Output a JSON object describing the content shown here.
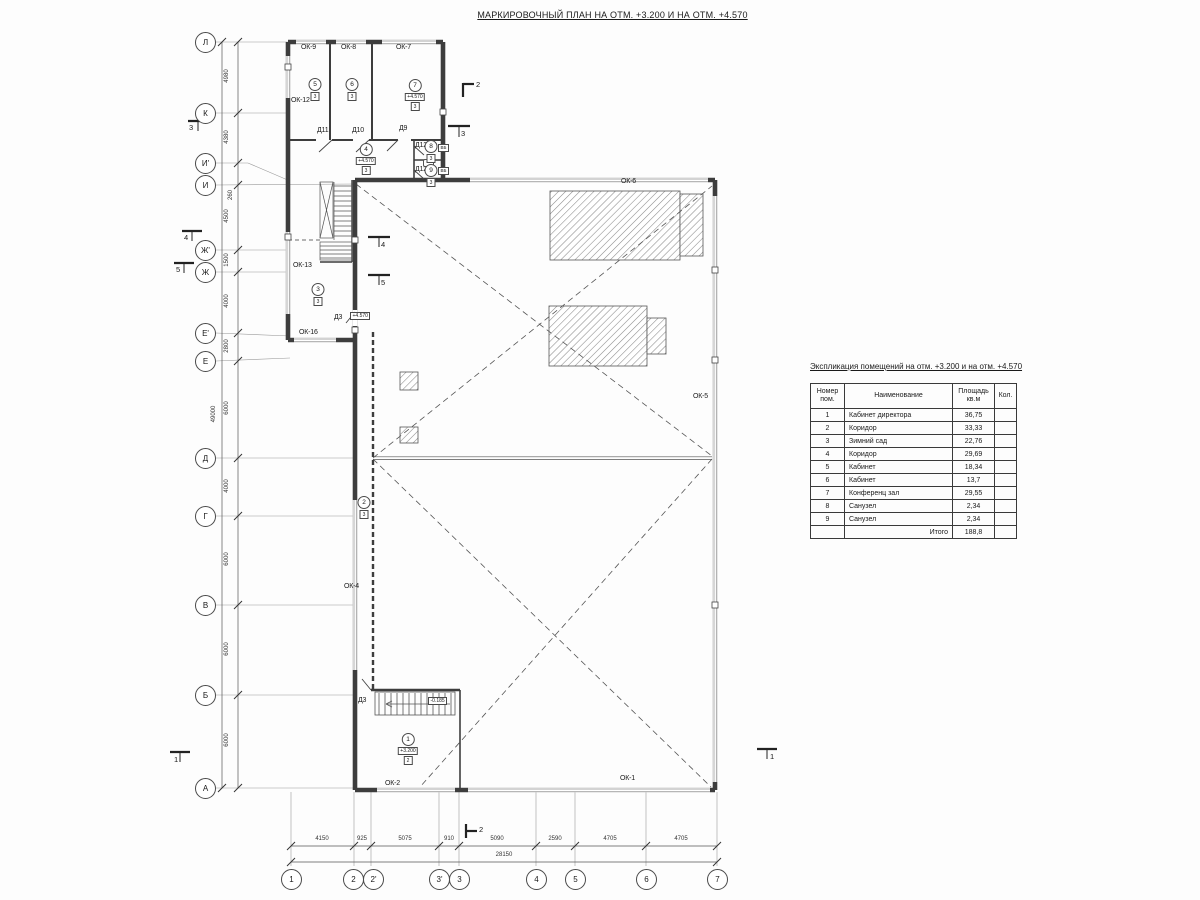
{
  "title": "МАРКИРОВОЧНЫЙ ПЛАН НА ОТМ. +3.200 И НА ОТМ. +4.570",
  "grid": {
    "rows": [
      "Л",
      "К",
      "И'",
      "И",
      "Ж'",
      "Ж",
      "Е'",
      "Е",
      "Д",
      "Г",
      "В",
      "Б",
      "А"
    ],
    "row_dims": [
      "4980",
      "4380",
      "260",
      "4500",
      "1500",
      "4000",
      "2800",
      "6000",
      "4000",
      "6000",
      "6000",
      "6000"
    ],
    "row_total": "49000",
    "cols": [
      "1",
      "2",
      "2'",
      "3'",
      "3",
      "4",
      "5",
      "6",
      "7"
    ],
    "col_dims": [
      "4150",
      "925",
      "5075",
      "910",
      "5090",
      "2590",
      "4705",
      "4705"
    ],
    "col_total": "28150"
  },
  "labels": {
    "ok9": "ОК-9",
    "ok8": "ОК-8",
    "ok7": "ОК-7",
    "ok12": "ОК-12",
    "ok13": "ОК-13",
    "ok16": "ОК-16",
    "ok6": "ОК-6",
    "ok5": "ОК-5",
    "ok4": "ОК-4",
    "ok2": "ОК-2",
    "ok1": "ОК-1",
    "d11": "Д11",
    "d10": "Д10",
    "d9": "Д9",
    "d12a": "Д12",
    "d12b": "Д12",
    "d3a": "Д3",
    "d3b": "Д3",
    "d3a_elev": "+4.570",
    "vb": "ВБ"
  },
  "rooms": [
    {
      "num": "1",
      "elev": "+3.200",
      "sub": "2"
    },
    {
      "num": "2",
      "sub": "3"
    },
    {
      "num": "3",
      "sub": "3"
    },
    {
      "num": "4",
      "elev": "+4.570",
      "sub": "3"
    },
    {
      "num": "5",
      "sub": "3"
    },
    {
      "num": "6",
      "sub": "3"
    },
    {
      "num": "7",
      "elev": "+4.570",
      "sub": "3"
    },
    {
      "num": "8",
      "sub": "3"
    },
    {
      "num": "9",
      "sub": "3"
    }
  ],
  "elev": {
    "stair": "-0.185"
  },
  "sections": {
    "s1": "1",
    "s2": "2",
    "s3": "3",
    "s4": "4",
    "s5": "5"
  },
  "table": {
    "title": "Экспликация помещений на отм. +3.200 и на отм. +4.570",
    "headers": {
      "num_l1": "Номер",
      "num_l2": "пом.",
      "name": "Наименование",
      "area_l1": "Площадь",
      "area_l2": "кв.м",
      "qty": "Кол."
    },
    "rows": [
      [
        "1",
        "Кабинет директора",
        "36,75"
      ],
      [
        "2",
        "Коридор",
        "33,33"
      ],
      [
        "3",
        "Зимний сад",
        "22,76"
      ],
      [
        "4",
        "Коридор",
        "29,69"
      ],
      [
        "5",
        "Кабинет",
        "18,34"
      ],
      [
        "6",
        "Кабинет",
        "13,7"
      ],
      [
        "7",
        "Конференц зал",
        "29,55"
      ],
      [
        "8",
        "Санузел",
        "2,34"
      ],
      [
        "9",
        "Санузел",
        "2,34"
      ]
    ],
    "total_label": "Итого",
    "total": "188,8"
  }
}
